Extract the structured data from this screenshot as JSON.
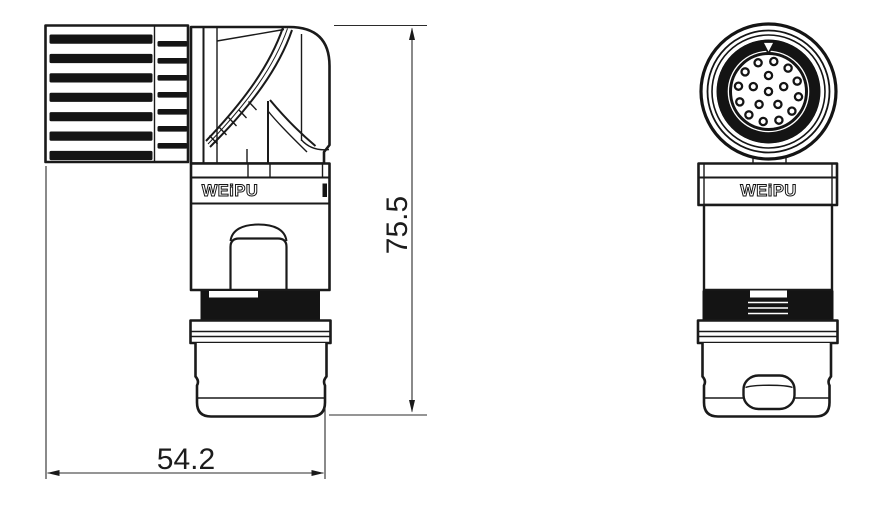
{
  "views": {
    "side": {
      "logo_text": "WEiPU",
      "knurl": {
        "large_rib_count": 7,
        "small_rib_count": 7
      }
    },
    "front": {
      "logo_text": "WEiPU",
      "pin_face": {
        "total_pins": 18,
        "rings": [
          {
            "count": 12,
            "radius": 30.5,
            "start_deg": -80
          },
          {
            "count": 5,
            "radius": 16,
            "start_deg": -90
          },
          {
            "count": 1,
            "radius": 0,
            "start_deg": 0
          }
        ]
      }
    }
  },
  "dimensions": {
    "width_label": "54.2",
    "height_label": "75.5"
  },
  "colors": {
    "line": "#1a1a1a",
    "background": "#ffffff",
    "thread_fill": "#141414"
  }
}
